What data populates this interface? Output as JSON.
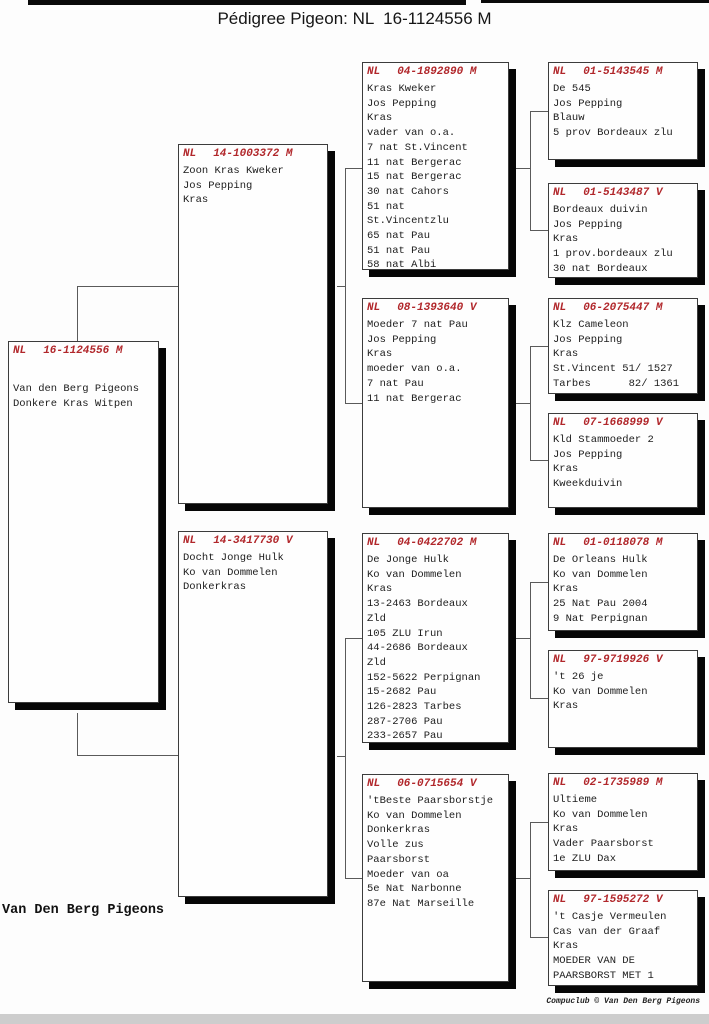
{
  "title": "Pédigree Pigeon: NL  16-1124556 M",
  "owner_signature": "Van Den Berg Pigeons",
  "footer_credit": "Compuclub © Van Den Berg Pigeons",
  "colors": {
    "ring_number_red": "#b1272b",
    "box_shadow_black": "#060606",
    "connector_line_gray": "#5a5a5a"
  },
  "boxes": [
    {
      "id": "subject",
      "country": "NL",
      "ring": "16-1124556 M",
      "lines": [
        "Van den Berg Pigeons",
        "Donkere Kras Witpen"
      ]
    },
    {
      "id": "sire",
      "country": "NL",
      "ring": "14-1003372 M",
      "lines": [
        "Zoon Kras Kweker",
        "Jos Pepping",
        "Kras"
      ]
    },
    {
      "id": "dam",
      "country": "NL",
      "ring": "14-3417730 V",
      "lines": [
        "Docht Jonge Hulk",
        "Ko van Dommelen",
        "Donkerkras"
      ]
    },
    {
      "id": "sire-sire",
      "country": "NL",
      "ring": "04-1892890 M",
      "lines": [
        "Kras Kweker",
        "Jos Pepping",
        "Kras",
        "vader van o.a.",
        "7 nat St.Vincent",
        "11 nat Bergerac",
        "15 nat Bergerac",
        "30 nat Cahors",
        "51 nat",
        "St.Vincentzlu",
        "65 nat Pau",
        "51 nat Pau",
        "58 nat Albi"
      ]
    },
    {
      "id": "sire-dam",
      "country": "NL",
      "ring": "08-1393640 V",
      "lines": [
        "Moeder 7 nat Pau",
        "Jos Pepping",
        "Kras",
        "moeder van o.a.",
        "7 nat Pau",
        "11 nat Bergerac"
      ]
    },
    {
      "id": "dam-sire",
      "country": "NL",
      "ring": "04-0422702 M",
      "lines": [
        "De Jonge Hulk",
        "Ko van Dommelen",
        "Kras",
        "13-2463 Bordeaux",
        "Zld",
        "105 ZLU Irun",
        "44-2686 Bordeaux",
        "Zld",
        "152-5622 Perpignan",
        "15-2682 Pau",
        "126-2823 Tarbes",
        "287-2706 Pau",
        "233-2657 Pau"
      ]
    },
    {
      "id": "dam-dam",
      "country": "NL",
      "ring": "06-0715654 V",
      "lines": [
        "'tBeste Paarsborstje",
        "Ko van Dommelen",
        "Donkerkras",
        "Volle zus",
        "Paarsborst",
        "Moeder van oa",
        "5e Nat Narbonne",
        "87e Nat Marseille"
      ]
    },
    {
      "id": "sire-sire-sire",
      "country": "NL",
      "ring": "01-5143545 M",
      "lines": [
        "De 545",
        "Jos Pepping",
        "Blauw",
        "5 prov Bordeaux zlu"
      ]
    },
    {
      "id": "sire-sire-dam",
      "country": "NL",
      "ring": "01-5143487 V",
      "lines": [
        "Bordeaux duivin",
        "Jos Pepping",
        "Kras",
        "1 prov.bordeaux zlu",
        "30 nat Bordeaux"
      ]
    },
    {
      "id": "sire-dam-sire",
      "country": "NL",
      "ring": "06-2075447 M",
      "lines": [
        "Klz Cameleon",
        "Jos Pepping",
        "Kras",
        "St.Vincent 51/ 1527",
        "Tarbes      82/ 1361"
      ]
    },
    {
      "id": "sire-dam-dam",
      "country": "NL",
      "ring": "07-1668999 V",
      "lines": [
        "Kld Stammoeder 2",
        "Jos Pepping",
        "Kras",
        "Kweekduivin"
      ]
    },
    {
      "id": "dam-sire-sire",
      "country": "NL",
      "ring": "01-0118078 M",
      "lines": [
        "De Orleans Hulk",
        "Ko van Dommelen",
        "Kras",
        "25 Nat Pau 2004",
        "9 Nat Perpignan"
      ]
    },
    {
      "id": "dam-sire-dam",
      "country": "NL",
      "ring": "97-9719926 V",
      "lines": [
        "'t 26 je",
        "Ko van Dommelen",
        "Kras"
      ]
    },
    {
      "id": "dam-dam-sire",
      "country": "NL",
      "ring": "02-1735989 M",
      "lines": [
        "Ultieme",
        "Ko van Dommelen",
        "Kras",
        "Vader Paarsborst",
        "1e ZLU Dax"
      ]
    },
    {
      "id": "dam-dam-dam",
      "country": "NL",
      "ring": "97-1595272 V",
      "lines": [
        "'t Casje Vermeulen",
        "Cas van der Graaf",
        "Kras",
        "MOEDER VAN DE",
        "PAARSBORST MET 1"
      ]
    }
  ]
}
